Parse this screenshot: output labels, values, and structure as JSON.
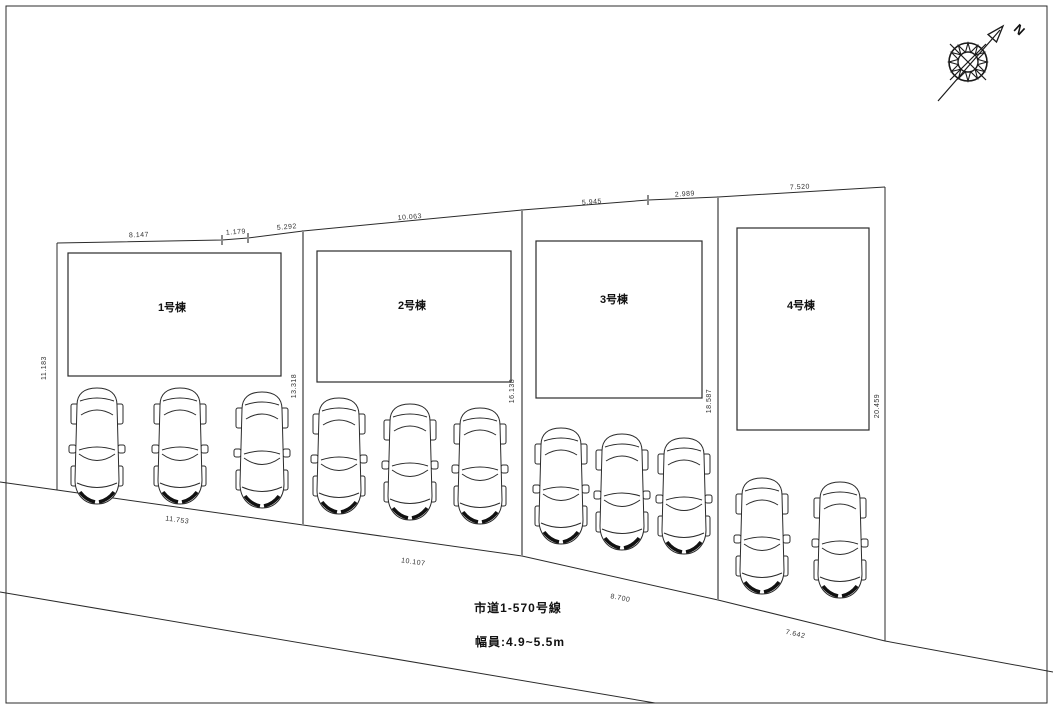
{
  "compass": {
    "north_label": "N"
  },
  "lots": [
    {
      "label": "1号棟"
    },
    {
      "label": "2号棟"
    },
    {
      "label": "3号棟"
    },
    {
      "label": "4号棟"
    }
  ],
  "dimensions": {
    "top": [
      "8.147",
      "1.179",
      "5.292",
      "10.063",
      "5.945",
      "2.989",
      "7.520"
    ],
    "left": "11.183",
    "dividers": [
      "13.318",
      "16.138",
      "18.587",
      "20.459"
    ],
    "bottom": [
      "11.753",
      "10.107",
      "8.700",
      "7.642"
    ]
  },
  "road": {
    "name": "市道1-570号線",
    "width": "幅員:4.9~5.5m"
  }
}
